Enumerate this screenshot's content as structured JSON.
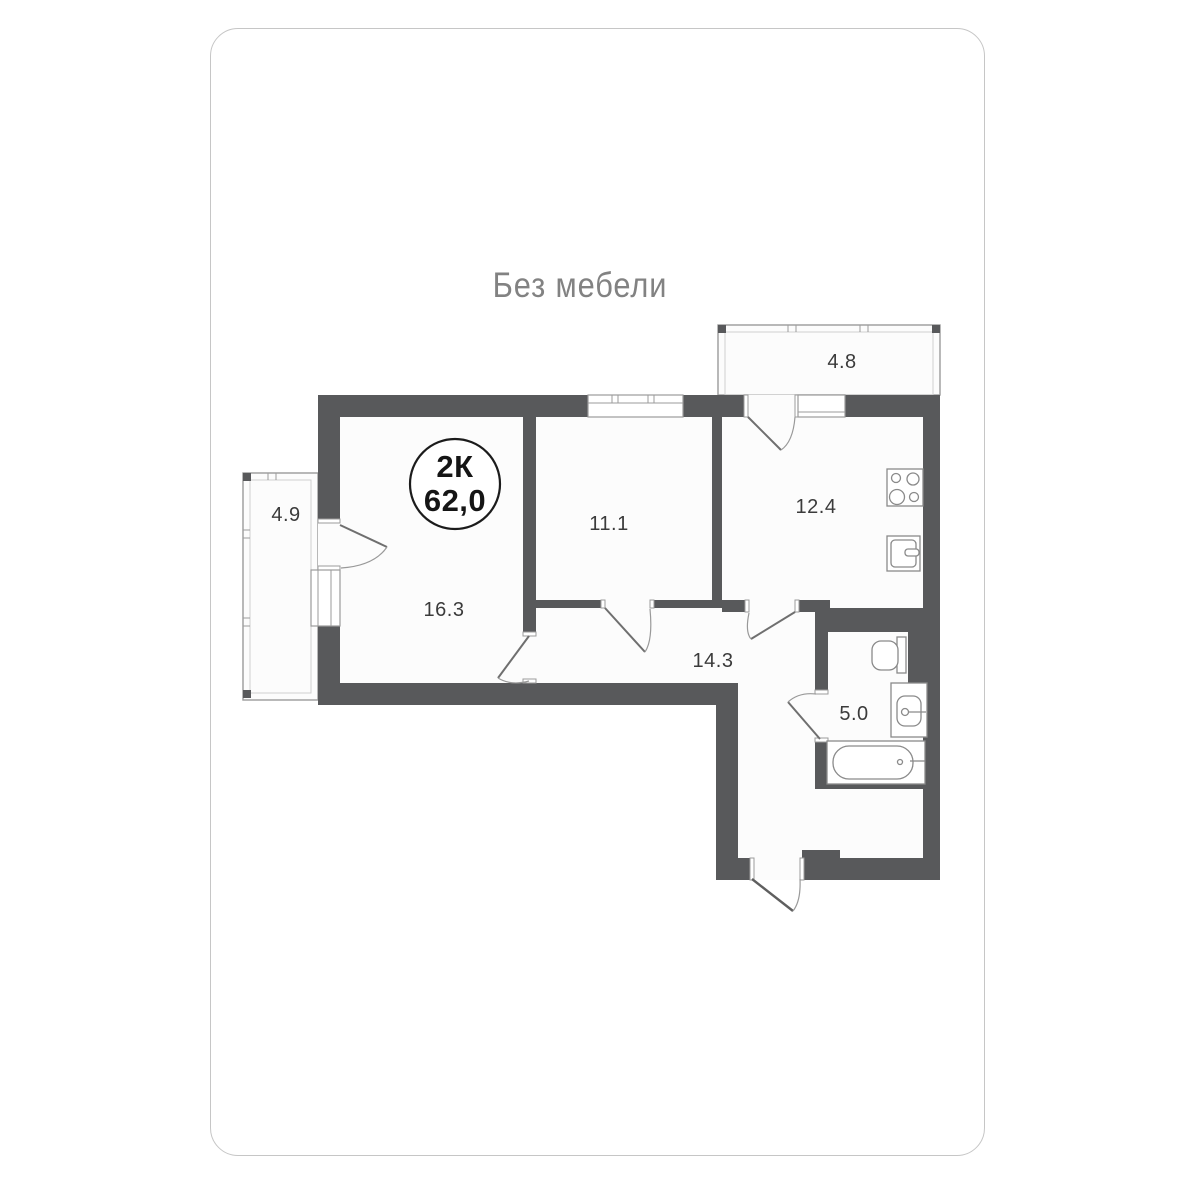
{
  "card": {
    "title": "Без мебели"
  },
  "badge": {
    "rooms_count": "2К",
    "area": "62,0"
  },
  "plan": {
    "room_labels": {
      "balcony_top": "4.8",
      "balcony_left": "4.9",
      "living": "16.3",
      "bedroom": "11.1",
      "kitchen": "12.4",
      "hallway": "14.3",
      "bathroom": "5.0"
    },
    "fixtures": [
      "stove-icon",
      "kitchen-sink-icon",
      "toilet-icon",
      "bath-sink-icon",
      "bathtub-icon"
    ],
    "colors": {
      "wall": "#58595b",
      "thin_line": "#9b9b9b",
      "inner_line": "#cfcfcf",
      "floor": "#fcfcfc",
      "label_text": "#3b3b3b",
      "title_text": "#828282",
      "badge_stroke": "#1c1c1c",
      "card_border": "#c6c6c6"
    }
  }
}
